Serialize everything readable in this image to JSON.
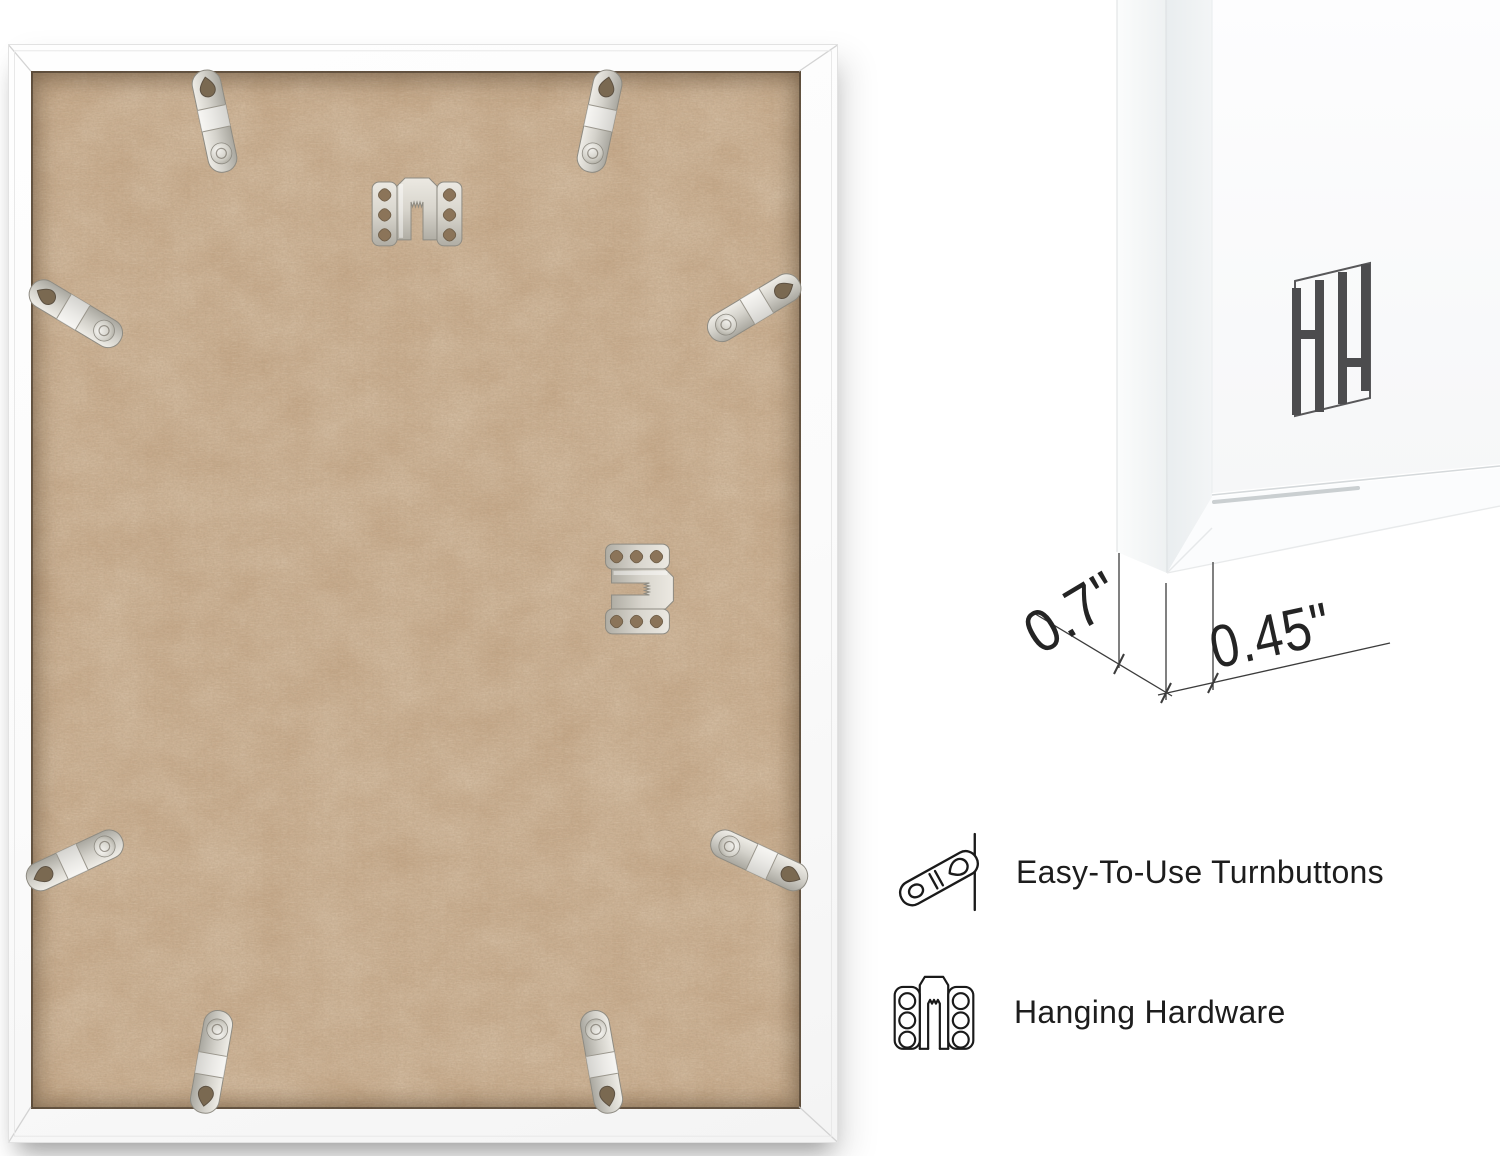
{
  "page": {
    "background": "#ffffff",
    "description": "white picture frame back and corner detail product image"
  },
  "frame_back_photo": {
    "board_color": "#c4a483",
    "frame_color": "#fcfcfc",
    "turnbutton_count": 8,
    "sawtooth_hanger_count": 2
  },
  "corner_detail": {
    "monogram": "HH",
    "measurements": {
      "depth": "0.7\"",
      "face": "0.45\""
    }
  },
  "features": [
    {
      "icon": "turnbutton-outline-icon",
      "label": "Easy-To-Use Turnbuttons"
    },
    {
      "icon": "hanging-hardware-outline-icon",
      "label": "Hanging Hardware"
    }
  ],
  "colors": {
    "text": "#1d1d1d",
    "annotation_line": "#3c3c3c",
    "logo": "#4c4c4e",
    "metal_light": "#eceae4",
    "metal_dark": "#a9a79f",
    "mdf_base": "#c4a483"
  }
}
